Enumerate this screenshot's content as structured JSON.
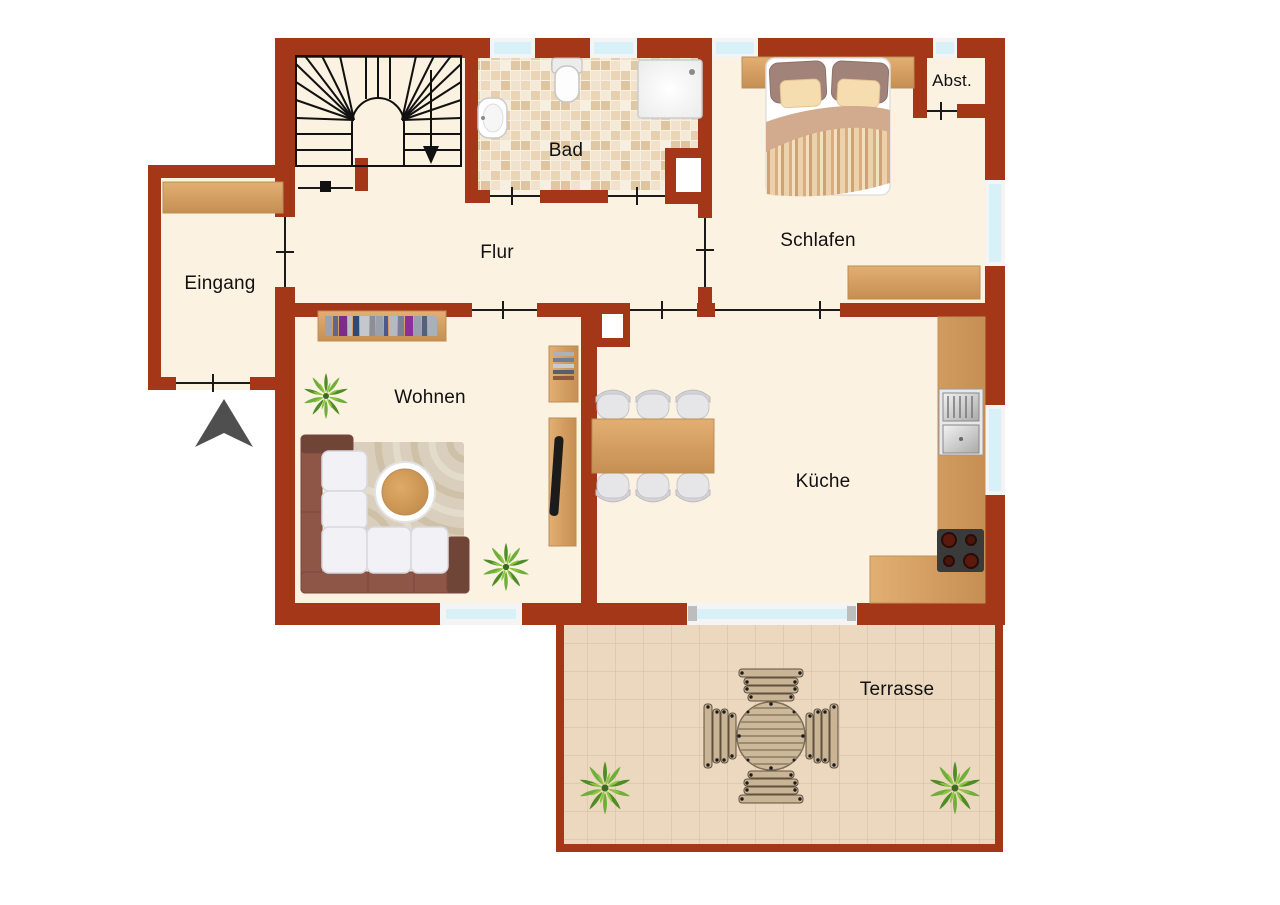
{
  "plan_type": "floor-plan",
  "rooms": {
    "bad": "Bad",
    "flur": "Flur",
    "schlafen": "Schlafen",
    "abstellraum": "Abst.",
    "eingang": "Eingang",
    "wohnen": "Wohnen",
    "kueche": "Küche",
    "terrasse": "Terrasse"
  },
  "colors": {
    "wall": "#a43718",
    "floor": "#fbf2e2",
    "outside": "#ffffff",
    "window_glass": "#d8f1f8",
    "window_frame": "#f4f4f4",
    "wood": "#d8a368",
    "bath_tile": "#e9d5b8",
    "terrace_tile": "#ecd8be",
    "sofa_frame": "#8d5647",
    "cushion": "#f2f1f5",
    "plant_green": "#6fae3a",
    "door_line": "#1a1a1a",
    "entrance_arrow": "#4f4f4f",
    "label_text": "#111111"
  }
}
